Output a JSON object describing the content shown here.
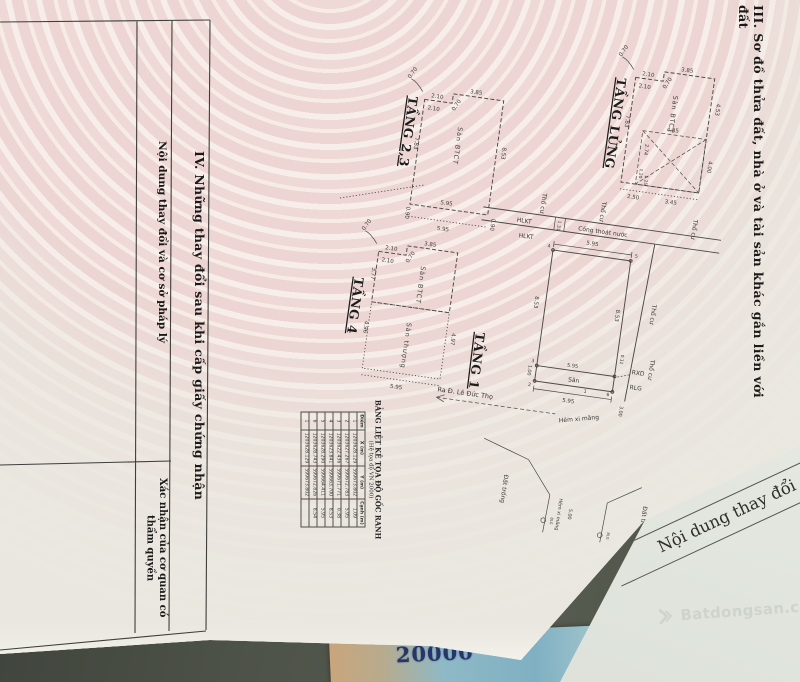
{
  "page": {
    "section3_title": "III. Sơ đồ thửa đất, nhà ở và tài sản khác gắn liền với đất",
    "section4": {
      "title": "IV. Những thay đổi sau khi cấp giấy chứng nhận",
      "col1": "Nội dung thay đổi và cơ sở pháp lý",
      "col2": "Xác nhận của cơ quan có thẩm quyền"
    }
  },
  "txt": {
    "tang23": "TẦNG 2,3",
    "tang_lung": "TẦNG LỬNG",
    "tang4": "TẦNG 4",
    "tang1": "TẦNG 1",
    "san_btct": "Sàn BTCT",
    "san_thuong": "Sàn thượng",
    "tho_cu": "Thổ cư",
    "hlkt": "HLKT",
    "cong_thoat": "Cống thoát nước",
    "san": "Sân",
    "rxd": "RXD",
    "rlg": "RLG",
    "ra_duong": "Ra Đ. Lê Đức Thọ",
    "hem_xm": "Hẻm xi măng",
    "dat_trong": "Đất trống",
    "blg": "BLG",
    "p1": "1",
    "p2": "2",
    "p3": "3",
    "p4": "4",
    "p5": "5",
    "p6": "6"
  },
  "num": {
    "d070": "0.70",
    "d210": "2.10",
    "d385": "3.85",
    "d783": "7.83",
    "d853": "8.53",
    "d595": "5.95",
    "d090": "0.90",
    "d453": "4.53",
    "d485": "4.85",
    "d274": "2.74",
    "d120": "1.20",
    "d125": "1.25",
    "d400": "4.00",
    "d250": "2.50",
    "d345": "3.45",
    "d377": "3.77",
    "d496": "4.96",
    "d497": "4.97",
    "d131": "1.31",
    "d100": "1.00",
    "d011": "0.11",
    "d300": "3.00",
    "d500": "5.00"
  },
  "coord_table": {
    "title": "BẢNG LIỆT KÊ TỌA ĐỘ GỐC RANH",
    "subtitle": "(Hệ tọa độ VN 2000)",
    "headers": [
      "Điểm",
      "X (m)",
      "Y (m)",
      "Cạnh (m)"
    ],
    "rows": [
      [
        "1",
        "1203628.129",
        "599673.802",
        "1.09"
      ],
      [
        "2",
        "1203627.267",
        "599672.783",
        "5.95"
      ],
      [
        "3",
        "1203622.436",
        "599671.771",
        "0.38"
      ],
      [
        "4",
        "1203623.841",
        "599663.700",
        "8.53"
      ],
      [
        "5",
        "1203628.290",
        "599664.411",
        "5.95"
      ],
      [
        "6",
        "1203628.743",
        "599672.826",
        "8.54"
      ],
      [
        "1",
        "1203628.129",
        "599673.802",
        ""
      ]
    ]
  },
  "underpage": {
    "text": "Nội dung thay đổi"
  },
  "watermark": {
    "text": "Batdongsan.com"
  },
  "banknote": {
    "value": "20000"
  }
}
